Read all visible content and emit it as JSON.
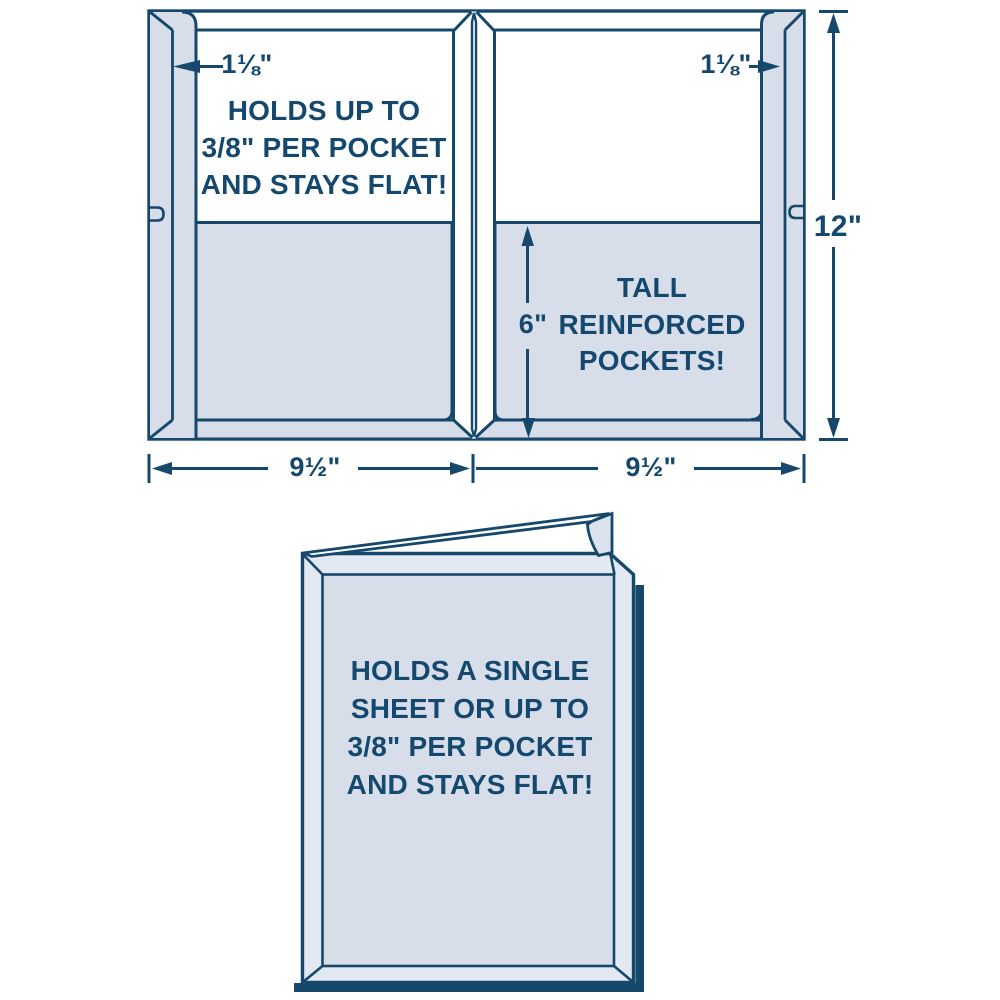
{
  "diagram_title": "presentation-folder-capacity-diagram",
  "colors": {
    "line": "#16486c",
    "text": "#14486e",
    "panel_fill": "#d7dde9",
    "cover_band_fill": "#e3e9f2",
    "background": "#ffffff"
  },
  "open_folder": {
    "flap_width_left": "1⅛\"",
    "flap_width_right": "1⅛\"",
    "height": "12\"",
    "pocket_height": "6\"",
    "panel_width_left": "9½\"",
    "panel_width_right": "9½\"",
    "left_panel_lines": [
      "HOLDS UP TO",
      "3/8\" PER POCKET",
      "AND STAYS FLAT!"
    ],
    "pocket_lines": [
      "TALL",
      "REINFORCED",
      "POCKETS!"
    ]
  },
  "closed_folder": {
    "front_lines": [
      "HOLDS A SINGLE",
      "SHEET OR UP TO",
      "3/8\" PER POCKET",
      "AND STAYS FLAT!"
    ]
  }
}
